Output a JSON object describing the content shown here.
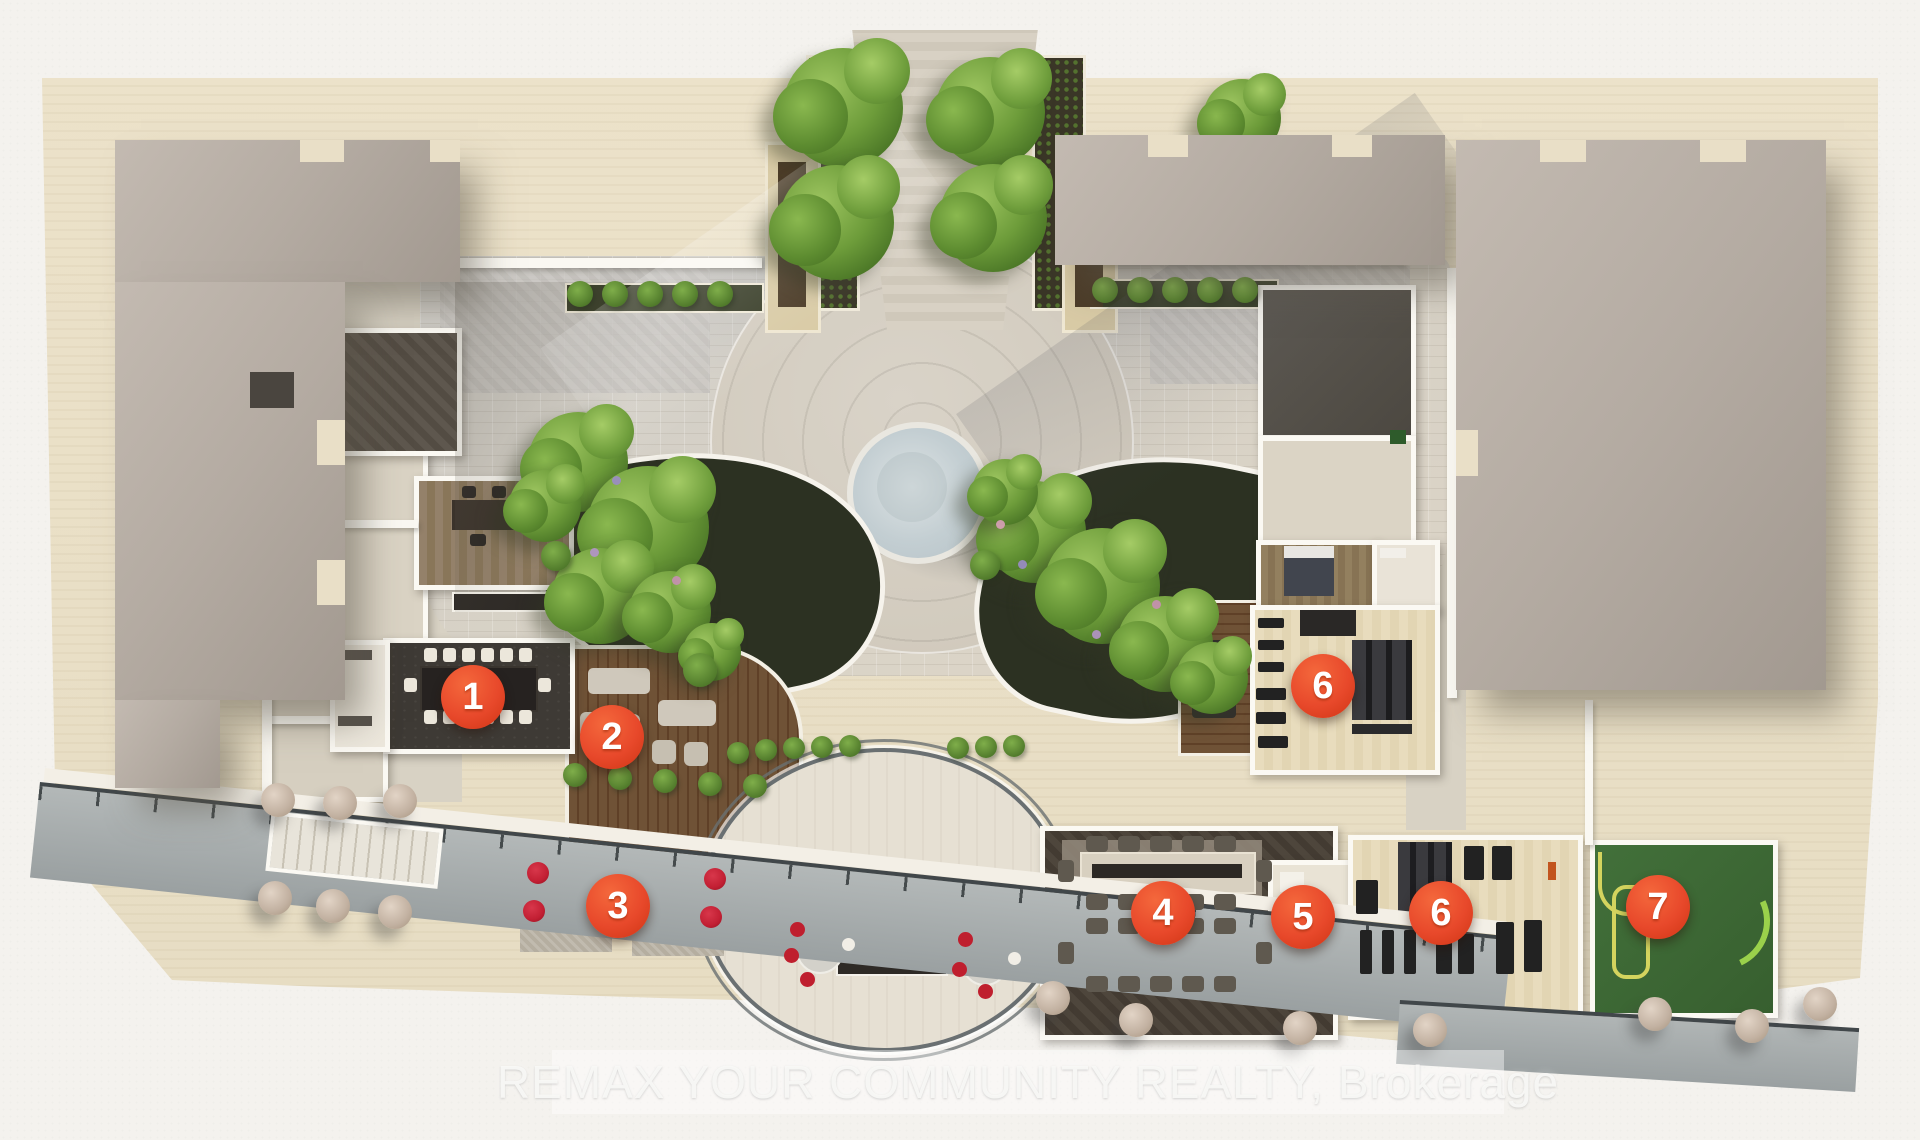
{
  "watermark": {
    "text": "REMAX YOUR COMMUNITY REALTY, Brokerage"
  },
  "markers": [
    {
      "label": "1",
      "x": 473,
      "y": 697
    },
    {
      "label": "2",
      "x": 612,
      "y": 737
    },
    {
      "label": "3",
      "x": 618,
      "y": 906
    },
    {
      "label": "4",
      "x": 1163,
      "y": 913
    },
    {
      "label": "5",
      "x": 1303,
      "y": 917
    },
    {
      "label": "6",
      "x": 1323,
      "y": 686
    },
    {
      "label": "6",
      "x": 1441,
      "y": 913
    },
    {
      "label": "7",
      "x": 1658,
      "y": 907
    }
  ],
  "palette": {
    "marker_orange": "#E8492B",
    "paper_white": "#F4F2EE",
    "deck_beige": "#EAE0C8",
    "roof_taupe": "#B5ACA3",
    "plaza_grey": "#D6D0C6",
    "tree_green": "#6D9C3A",
    "wood_deck_brown": "#6F5236",
    "fountain_water": "#C3CED2",
    "games_room_green": "#3D6833",
    "sofa_blue": "#24489C",
    "chair_red": "#C21F33"
  }
}
